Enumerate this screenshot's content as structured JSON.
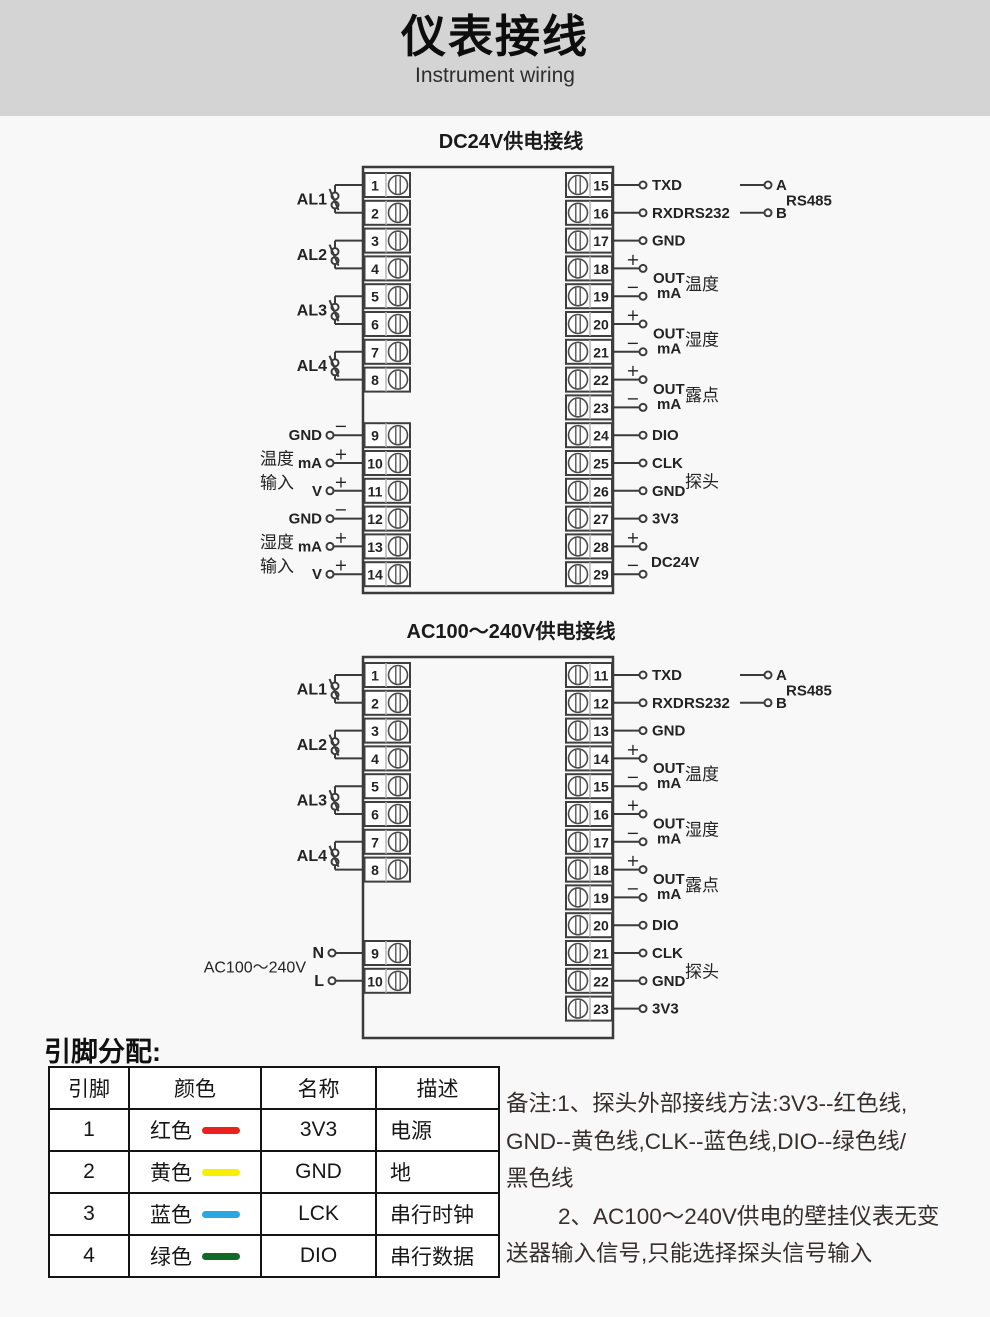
{
  "header": {
    "title": "仪表接线",
    "subtitle": "Instrument wiring"
  },
  "colors": {
    "header_band": "#d4d4d4",
    "page_bg": "#f8f8f8",
    "diagram_line": "#3b3b3b",
    "red": "#e8231d",
    "yellow": "#f7ef00",
    "blue": "#2aa7e0",
    "green": "#0f6c28"
  },
  "diagrams": [
    {
      "title": "DC24V供电接线",
      "left": {
        "terminals": [
          {
            "n": "1",
            "slot": 0
          },
          {
            "n": "2",
            "slot": 1
          },
          {
            "n": "3",
            "slot": 2
          },
          {
            "n": "4",
            "slot": 3
          },
          {
            "n": "5",
            "slot": 4
          },
          {
            "n": "6",
            "slot": 5
          },
          {
            "n": "7",
            "slot": 6
          },
          {
            "n": "8",
            "slot": 7
          },
          {
            "n": "9",
            "slot": 9
          },
          {
            "n": "10",
            "slot": 10
          },
          {
            "n": "11",
            "slot": 11
          },
          {
            "n": "12",
            "slot": 12
          },
          {
            "n": "13",
            "slot": 13
          },
          {
            "n": "14",
            "slot": 14
          }
        ],
        "switches": [
          {
            "label": "AL1",
            "slots": [
              0,
              1
            ]
          },
          {
            "label": "AL2",
            "slots": [
              2,
              3
            ]
          },
          {
            "label": "AL3",
            "slots": [
              4,
              5
            ]
          },
          {
            "label": "AL4",
            "slots": [
              6,
              7
            ]
          }
        ],
        "inputs": [
          {
            "label": "GND",
            "sign": "−",
            "slot": 9
          },
          {
            "label": "mA",
            "sign": "+",
            "slot": 10
          },
          {
            "label": "V",
            "sign": "+",
            "slot": 11
          },
          {
            "label": "GND",
            "sign": "−",
            "slot": 12
          },
          {
            "label": "mA",
            "sign": "+",
            "slot": 13
          },
          {
            "label": "V",
            "sign": "+",
            "slot": 14
          }
        ],
        "groups": [
          {
            "line1": "温度",
            "line2": "输入",
            "anchor_slot": 10
          },
          {
            "line1": "湿度",
            "line2": "输入",
            "anchor_slot": 13
          }
        ]
      },
      "right": {
        "terminals": [
          {
            "n": "15",
            "slot": 0
          },
          {
            "n": "16",
            "slot": 1
          },
          {
            "n": "17",
            "slot": 2
          },
          {
            "n": "18",
            "slot": 3
          },
          {
            "n": "19",
            "slot": 4
          },
          {
            "n": "20",
            "slot": 5
          },
          {
            "n": "21",
            "slot": 6
          },
          {
            "n": "22",
            "slot": 7
          },
          {
            "n": "23",
            "slot": 8
          },
          {
            "n": "24",
            "slot": 9
          },
          {
            "n": "25",
            "slot": 10
          },
          {
            "n": "26",
            "slot": 11
          },
          {
            "n": "27",
            "slot": 12
          },
          {
            "n": "28",
            "slot": 13
          },
          {
            "n": "29",
            "slot": 14
          }
        ],
        "connections": [
          {
            "type": "plain",
            "slot": 0,
            "label": "TXD"
          },
          {
            "type": "plain",
            "slot": 1,
            "label": "RXD",
            "tag": "RS232"
          },
          {
            "type": "plain",
            "slot": 2,
            "label": "GND"
          },
          {
            "type": "pair",
            "slots": [
              3,
              4
            ],
            "sign1": "+",
            "sign2": "−",
            "sub1": "OUT",
            "sub2": "mA",
            "label": "温度"
          },
          {
            "type": "pair",
            "slots": [
              5,
              6
            ],
            "sign1": "+",
            "sign2": "−",
            "sub1": "OUT",
            "sub2": "mA",
            "label": "湿度"
          },
          {
            "type": "pair",
            "slots": [
              7,
              8
            ],
            "sign1": "+",
            "sign2": "−",
            "sub1": "OUT",
            "sub2": "mA",
            "label": "露点"
          },
          {
            "type": "plain",
            "slot": 9,
            "label": "DIO"
          },
          {
            "type": "plain",
            "slot": 10,
            "label": "CLK"
          },
          {
            "type": "plain",
            "slot": 11,
            "label": "GND"
          },
          {
            "type": "plain",
            "slot": 12,
            "label": "3V3"
          },
          {
            "type": "pair",
            "slots": [
              13,
              14
            ],
            "sign1": "+",
            "sign2": "−",
            "label": "DC24V"
          }
        ],
        "probe": {
          "label": "探头",
          "slots": [
            10,
            11
          ]
        },
        "rs485": {
          "wire_a": "A",
          "wire_b": "B",
          "label": "RS485",
          "slots": [
            0,
            1
          ]
        }
      }
    },
    {
      "title": "AC100～240V供电接线",
      "left": {
        "terminals": [
          {
            "n": "1",
            "slot": 0
          },
          {
            "n": "2",
            "slot": 1
          },
          {
            "n": "3",
            "slot": 2
          },
          {
            "n": "4",
            "slot": 3
          },
          {
            "n": "5",
            "slot": 4
          },
          {
            "n": "6",
            "slot": 5
          },
          {
            "n": "7",
            "slot": 6
          },
          {
            "n": "8",
            "slot": 7
          },
          {
            "n": "9",
            "slot": 10
          },
          {
            "n": "10",
            "slot": 11
          }
        ],
        "switches": [
          {
            "label": "AL1",
            "slots": [
              0,
              1
            ]
          },
          {
            "label": "AL2",
            "slots": [
              2,
              3
            ]
          },
          {
            "label": "AL3",
            "slots": [
              4,
              5
            ]
          },
          {
            "label": "AL4",
            "slots": [
              6,
              7
            ]
          }
        ],
        "power": {
          "label": "AC100～240V",
          "line_n": "N",
          "line_l": "L",
          "slots": [
            10,
            11
          ]
        }
      },
      "right": {
        "terminals": [
          {
            "n": "11",
            "slot": 0
          },
          {
            "n": "12",
            "slot": 1
          },
          {
            "n": "13",
            "slot": 2
          },
          {
            "n": "14",
            "slot": 3
          },
          {
            "n": "15",
            "slot": 4
          },
          {
            "n": "16",
            "slot": 5
          },
          {
            "n": "17",
            "slot": 6
          },
          {
            "n": "18",
            "slot": 7
          },
          {
            "n": "19",
            "slot": 8
          },
          {
            "n": "20",
            "slot": 9
          },
          {
            "n": "21",
            "slot": 10
          },
          {
            "n": "22",
            "slot": 11
          },
          {
            "n": "23",
            "slot": 12
          }
        ],
        "connections": [
          {
            "type": "plain",
            "slot": 0,
            "label": "TXD"
          },
          {
            "type": "plain",
            "slot": 1,
            "label": "RXD",
            "tag": "RS232"
          },
          {
            "type": "plain",
            "slot": 2,
            "label": "GND"
          },
          {
            "type": "pair",
            "slots": [
              3,
              4
            ],
            "sign1": "+",
            "sign2": "−",
            "sub1": "OUT",
            "sub2": "mA",
            "label": "温度"
          },
          {
            "type": "pair",
            "slots": [
              5,
              6
            ],
            "sign1": "+",
            "sign2": "−",
            "sub1": "OUT",
            "sub2": "mA",
            "label": "湿度"
          },
          {
            "type": "pair",
            "slots": [
              7,
              8
            ],
            "sign1": "+",
            "sign2": "−",
            "sub1": "OUT",
            "sub2": "mA",
            "label": "露点"
          },
          {
            "type": "plain",
            "slot": 9,
            "label": "DIO"
          },
          {
            "type": "plain",
            "slot": 10,
            "label": "CLK"
          },
          {
            "type": "plain",
            "slot": 11,
            "label": "GND"
          },
          {
            "type": "plain",
            "slot": 12,
            "label": "3V3"
          }
        ],
        "probe": {
          "label": "探头",
          "slots": [
            10,
            11
          ]
        },
        "rs485": {
          "wire_a": "A",
          "wire_b": "B",
          "label": "RS485",
          "slots": [
            0,
            1
          ]
        }
      }
    }
  ],
  "pin_table": {
    "heading": "引脚分配:",
    "headers": [
      "引脚",
      "颜色",
      "名称",
      "描述"
    ],
    "rows": [
      {
        "pin": "1",
        "color": "红色",
        "hex": "#e8231d",
        "name": "3V3",
        "desc": "电源"
      },
      {
        "pin": "2",
        "color": "黄色",
        "hex": "#f7ef00",
        "name": "GND",
        "desc": "地"
      },
      {
        "pin": "3",
        "color": "蓝色",
        "hex": "#2aa7e0",
        "name": "LCK",
        "desc": "串行时钟"
      },
      {
        "pin": "4",
        "color": "绿色",
        "hex": "#0f6c28",
        "name": "DIO",
        "desc": "串行数据"
      }
    ]
  },
  "notes": {
    "lines": [
      "备注:1、探头外部接线方法:3V3--红色线,",
      "GND--黄色线,CLK--蓝色线,DIO--绿色线/",
      "黑色线",
      "2、AC100～240V供电的壁挂仪表无变",
      "送器输入信号,只能选择探头信号输入"
    ]
  }
}
